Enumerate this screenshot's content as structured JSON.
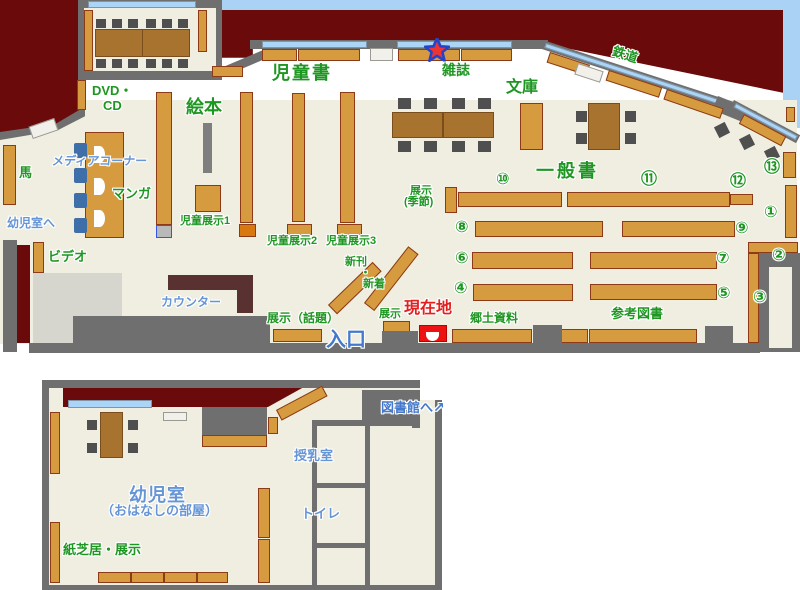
{
  "title": "図書館 フロアマップ（児童室・幼児室）",
  "colors": {
    "floor": "#efeee1",
    "wall": "#6f6f6f",
    "stack_area": "#6b0a0a",
    "shelf": "#d59b3e",
    "shelf_border": "#8c3a18",
    "window": "#abd5f6",
    "exterior_sky": "#a9d2f5",
    "table": "#a8722f",
    "chair": "#4f4f4f",
    "label_green": "#1e9622",
    "label_blue": "#6695d6",
    "label_blue_strong": "#4479cc",
    "label_red": "#e31f1f",
    "current_location_box": "#ee1111",
    "counter": "#5a3131",
    "media_seat_blue": "#3e6fa8"
  },
  "icons": {
    "current_location_star": "★",
    "to_library_arrow": "↗"
  },
  "floor1": {
    "labels": {
      "jidosho": "児童書",
      "ehon": "絵本",
      "zasshi": "雑誌",
      "bunko": "文庫",
      "tetsudo": "鉄道",
      "dvd_line1": "DVD・",
      "dvd_line2": "CD",
      "media_corner": "メディアコーナー",
      "manga": "マンガ",
      "uma": "馬",
      "to_yojishitsu": "幼児室へ",
      "video": "ビデオ",
      "counter": "カウンター",
      "jido_tenji1": "児童展示1",
      "jido_tenji2": "児童展示2",
      "jido_tenji3": "児童展示3",
      "shinkan": "新刊",
      "naka_dot": "・",
      "shinchaku": "新着",
      "tenji_kisetsu_1": "展示",
      "tenji_kisetsu_2": "(季節)",
      "ippansho": "一般書",
      "tenji_wadai": "展示（話題）",
      "tenji": "展示",
      "genzaichi": "現在地",
      "iriguchi": "入口",
      "kyodo_shiryo": "郷土資料",
      "sanko_tosho": "参考図書"
    },
    "numbers": [
      "①",
      "②",
      "③",
      "④",
      "⑤",
      "⑥",
      "⑦",
      "⑧",
      "⑨",
      "⑩",
      "⑪",
      "⑫",
      "⑬"
    ]
  },
  "annex": {
    "labels": {
      "to_toshokan": "図書館へ",
      "junyushitsu": "授乳室",
      "toire": "トイレ",
      "yojishitsu": "幼児室",
      "ohanashi": "（おはなしの部屋）",
      "kamishibai": "紙芝居・展示"
    }
  }
}
